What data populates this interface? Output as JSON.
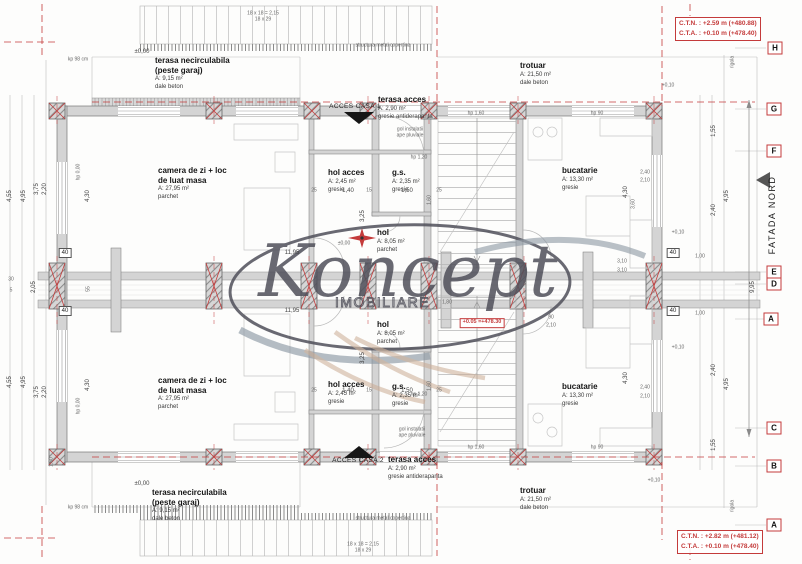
{
  "drawing": {
    "watermark": {
      "brand": "Koncept",
      "subtitle": "IMOBILIARE"
    },
    "facade_label": "FATADA NORD",
    "annotations": {
      "top_right": [
        "C.T.N. : +2.59 m (+480.88)",
        "C.T.A. : +0.10 m (+478.40)"
      ],
      "bottom_right": [
        "C.T.N. : +2.82 m (+481.12)",
        "C.T.A. : +0.10 m (+478.40)"
      ],
      "center_level": "+0.05 =+478.30"
    },
    "colors": {
      "axis_red": "#c43b3b",
      "wall_gray": "#d4d4d4",
      "watermark_gray": "#50505a",
      "watermark_beige": "#c9ab92"
    },
    "grid_markers": [
      {
        "label": "H",
        "x": 775,
        "y": 48
      },
      {
        "label": "G",
        "x": 774,
        "y": 109
      },
      {
        "label": "F",
        "x": 774,
        "y": 151
      },
      {
        "label": "E",
        "x": 774,
        "y": 272
      },
      {
        "label": "D",
        "x": 774,
        "y": 284
      },
      {
        "label": "A",
        "x": 771,
        "y": 319
      },
      {
        "label": "C",
        "x": 774,
        "y": 428
      },
      {
        "label": "B",
        "x": 774,
        "y": 466
      },
      {
        "label": "A",
        "x": 774,
        "y": 525
      }
    ],
    "rooms": [
      {
        "name": "terasa necirculabila",
        "name2": "(peste garaj)",
        "area": "A: 9,15 m²",
        "finish": "dale beton",
        "x": 155,
        "y": 56
      },
      {
        "name": "camera de zi + loc",
        "name2": "de luat masa",
        "area": "A: 27,95 m²",
        "finish": "parchet",
        "x": 158,
        "y": 166
      },
      {
        "name": "hol acces",
        "area": "A: 2,45 m²",
        "finish": "gresie",
        "x": 328,
        "y": 168
      },
      {
        "name": "g.s.",
        "area": "A: 2,35 m²",
        "finish": "gresie",
        "x": 392,
        "y": 168
      },
      {
        "name": "terasa acces",
        "area": "A: 2,90 m²",
        "finish": "gresie antiderapanta",
        "x": 378,
        "y": 95
      },
      {
        "name": "trotuar",
        "area": "A: 21,50 m²",
        "finish": "dale beton",
        "x": 520,
        "y": 61
      },
      {
        "name": "bucatarie",
        "area": "A: 13,30 m²",
        "finish": "gresie",
        "x": 562,
        "y": 166
      },
      {
        "name": "hol",
        "area": "A: 8,05 m²",
        "finish": "parchet",
        "x": 377,
        "y": 228
      },
      {
        "name": "hol",
        "area": "A: 8,05 m²",
        "finish": "parchet",
        "x": 377,
        "y": 320
      },
      {
        "name": "camera de zi + loc",
        "name2": "de luat masa",
        "area": "A: 27,95 m²",
        "finish": "parchet",
        "x": 158,
        "y": 376
      },
      {
        "name": "hol acces",
        "area": "A: 2,45 m²",
        "finish": "gresie",
        "x": 328,
        "y": 380
      },
      {
        "name": "g.s.",
        "area": "A: 2,35 m²",
        "finish": "gresie",
        "x": 392,
        "y": 382
      },
      {
        "name": "bucatarie",
        "area": "A: 13,30 m²",
        "finish": "gresie",
        "x": 562,
        "y": 382
      },
      {
        "name": "terasa acces",
        "area": "A: 2,90 m²",
        "finish": "gresie antiderapanta",
        "x": 388,
        "y": 455
      },
      {
        "name": "trotuar",
        "area": "A: 21,50 m²",
        "finish": "dale beton",
        "x": 520,
        "y": 486
      },
      {
        "name": "terasa necirculabila",
        "name2": "(peste garaj)",
        "area": "A: 9,15 m²",
        "finish": "dale beton",
        "x": 152,
        "y": 488
      }
    ],
    "dims": [
      {
        "t": "18 x 18 = 2,15",
        "x": 263,
        "y": 14,
        "c": "xs"
      },
      {
        "t": "18 x 29",
        "x": 263,
        "y": 20,
        "c": "xs"
      },
      {
        "t": "structura metal copertina",
        "x": 383,
        "y": 46,
        "c": "xs"
      },
      {
        "t": "±0,00",
        "x": 142,
        "y": 52
      },
      {
        "t": "kp 98 cm",
        "x": 78,
        "y": 60,
        "c": "xs"
      },
      {
        "t": "ACCES CASA 1",
        "x": 355,
        "y": 107,
        "c": "caps"
      },
      {
        "t": "gol instalatii",
        "x": 410,
        "y": 130,
        "c": "xs"
      },
      {
        "t": "ape pluviale",
        "x": 410,
        "y": 136,
        "c": "xs"
      },
      {
        "t": "hp 1,60",
        "x": 476,
        "y": 114,
        "c": "xs"
      },
      {
        "t": "hp 90",
        "x": 597,
        "y": 114,
        "c": "xs"
      },
      {
        "t": "hp 1,20",
        "x": 419,
        "y": 158,
        "c": "xs"
      },
      {
        "t": "hp 0,00",
        "x": 79,
        "y": 172,
        "r": 1,
        "c": "xs"
      },
      {
        "t": "4,55",
        "x": 10,
        "y": 196,
        "r": 1
      },
      {
        "t": "4,95",
        "x": 24,
        "y": 196,
        "r": 1
      },
      {
        "t": "3,75",
        "x": 37,
        "y": 189,
        "r": 1
      },
      {
        "t": "2,20",
        "x": 45,
        "y": 189,
        "r": 1
      },
      {
        "t": "4,30",
        "x": 88,
        "y": 196,
        "r": 1
      },
      {
        "t": "30",
        "x": 11,
        "y": 280,
        "c": "xs"
      },
      {
        "t": "5",
        "x": 11,
        "y": 291,
        "c": "xs"
      },
      {
        "t": "2,05",
        "x": 34,
        "y": 287,
        "r": 1
      },
      {
        "t": "55",
        "x": 89,
        "y": 289,
        "r": 1,
        "c": "xs"
      },
      {
        "t": "40",
        "x": 65,
        "y": 253,
        "c": "box"
      },
      {
        "t": "40",
        "x": 65,
        "y": 311,
        "c": "box"
      },
      {
        "t": "4,55",
        "x": 10,
        "y": 382,
        "r": 1
      },
      {
        "t": "4,95",
        "x": 24,
        "y": 382,
        "r": 1
      },
      {
        "t": "3,75",
        "x": 37,
        "y": 392,
        "r": 1
      },
      {
        "t": "2,20",
        "x": 45,
        "y": 392,
        "r": 1
      },
      {
        "t": "4,30",
        "x": 88,
        "y": 385,
        "r": 1
      },
      {
        "t": "hp 0,00",
        "x": 79,
        "y": 406,
        "r": 1,
        "c": "xs"
      },
      {
        "t": "1,60",
        "x": 52,
        "y": 462,
        "r": 1,
        "c": "xs"
      },
      {
        "t": "11,95",
        "x": 292,
        "y": 253
      },
      {
        "t": "11,95",
        "x": 292,
        "y": 311
      },
      {
        "t": "±0,00",
        "x": 344,
        "y": 244,
        "c": "xs"
      },
      {
        "t": "25",
        "x": 314,
        "y": 191,
        "c": "xs"
      },
      {
        "t": "1,40",
        "x": 348,
        "y": 191
      },
      {
        "t": "15",
        "x": 369,
        "y": 191,
        "c": "xs"
      },
      {
        "t": "1,50",
        "x": 407,
        "y": 191
      },
      {
        "t": "25",
        "x": 439,
        "y": 191,
        "c": "xs"
      },
      {
        "t": "3,25",
        "x": 363,
        "y": 216,
        "r": 1
      },
      {
        "t": "1,60",
        "x": 430,
        "y": 200,
        "r": 1,
        "c": "xs"
      },
      {
        "t": "25",
        "x": 314,
        "y": 391,
        "c": "xs"
      },
      {
        "t": "1,40",
        "x": 348,
        "y": 391
      },
      {
        "t": "15",
        "x": 369,
        "y": 391,
        "c": "xs"
      },
      {
        "t": "1,50",
        "x": 407,
        "y": 391
      },
      {
        "t": "25",
        "x": 439,
        "y": 391,
        "c": "xs"
      },
      {
        "t": "3,25",
        "x": 363,
        "y": 358,
        "r": 1
      },
      {
        "t": "1,60",
        "x": 430,
        "y": 386,
        "r": 1,
        "c": "xs"
      },
      {
        "t": "1,80",
        "x": 447,
        "y": 303,
        "c": "xs"
      },
      {
        "t": "90",
        "x": 551,
        "y": 318,
        "c": "xs"
      },
      {
        "t": "2,10",
        "x": 551,
        "y": 326,
        "c": "xs"
      },
      {
        "t": "2,40",
        "x": 645,
        "y": 173,
        "c": "xs"
      },
      {
        "t": "2,10",
        "x": 645,
        "y": 181,
        "c": "xs"
      },
      {
        "t": "4,30",
        "x": 626,
        "y": 192,
        "r": 1
      },
      {
        "t": "3,60",
        "x": 634,
        "y": 204,
        "r": 1,
        "c": "xs"
      },
      {
        "t": "3,10",
        "x": 622,
        "y": 262,
        "c": "xs"
      },
      {
        "t": "3,10",
        "x": 622,
        "y": 271,
        "c": "xs"
      },
      {
        "t": "1,00",
        "x": 700,
        "y": 257,
        "c": "xs"
      },
      {
        "t": "1,00",
        "x": 700,
        "y": 314,
        "c": "xs"
      },
      {
        "t": "40",
        "x": 673,
        "y": 253,
        "c": "box"
      },
      {
        "t": "40",
        "x": 673,
        "y": 311,
        "c": "box"
      },
      {
        "t": "2,40",
        "x": 645,
        "y": 388,
        "c": "xs"
      },
      {
        "t": "2,10",
        "x": 645,
        "y": 397,
        "c": "xs"
      },
      {
        "t": "4,30",
        "x": 626,
        "y": 378,
        "r": 1
      },
      {
        "t": "1,55",
        "x": 714,
        "y": 131,
        "r": 1
      },
      {
        "t": "2,40",
        "x": 714,
        "y": 210,
        "r": 1
      },
      {
        "t": "2,40",
        "x": 714,
        "y": 370,
        "r": 1
      },
      {
        "t": "1,55",
        "x": 714,
        "y": 445,
        "r": 1
      },
      {
        "t": "4,95",
        "x": 727,
        "y": 196,
        "r": 1
      },
      {
        "t": "4,95",
        "x": 727,
        "y": 384,
        "r": 1
      },
      {
        "t": "9,95",
        "x": 753,
        "y": 287,
        "r": 1
      },
      {
        "t": "rigola",
        "x": 733,
        "y": 62,
        "r": 1,
        "c": "xs"
      },
      {
        "t": "rigola",
        "x": 733,
        "y": 506,
        "r": 1,
        "c": "xs"
      },
      {
        "t": "+0,10",
        "x": 668,
        "y": 86,
        "c": "xs"
      },
      {
        "t": "+0,10",
        "x": 678,
        "y": 233,
        "c": "xs"
      },
      {
        "t": "+0,10",
        "x": 678,
        "y": 348,
        "c": "xs"
      },
      {
        "t": "+0,10",
        "x": 654,
        "y": 481,
        "c": "xs"
      },
      {
        "t": "hp 1,60",
        "x": 476,
        "y": 448,
        "c": "xs"
      },
      {
        "t": "hp 90",
        "x": 597,
        "y": 448,
        "c": "xs"
      },
      {
        "t": "hp 1,20",
        "x": 419,
        "y": 395,
        "c": "xs"
      },
      {
        "t": "gol instalatii",
        "x": 412,
        "y": 430,
        "c": "xs"
      },
      {
        "t": "ape pluviale",
        "x": 412,
        "y": 436,
        "c": "xs"
      },
      {
        "t": "ACCES CASA 2",
        "x": 358,
        "y": 461,
        "c": "caps"
      },
      {
        "t": "±0,00",
        "x": 142,
        "y": 484
      },
      {
        "t": "kp 98 cm",
        "x": 78,
        "y": 508,
        "c": "xs"
      },
      {
        "t": "structura metal copertina",
        "x": 383,
        "y": 519,
        "c": "xs"
      },
      {
        "t": "18 x 18 = 2,15",
        "x": 363,
        "y": 545,
        "c": "xs"
      },
      {
        "t": "18 x 29",
        "x": 363,
        "y": 551,
        "c": "xs"
      }
    ]
  }
}
